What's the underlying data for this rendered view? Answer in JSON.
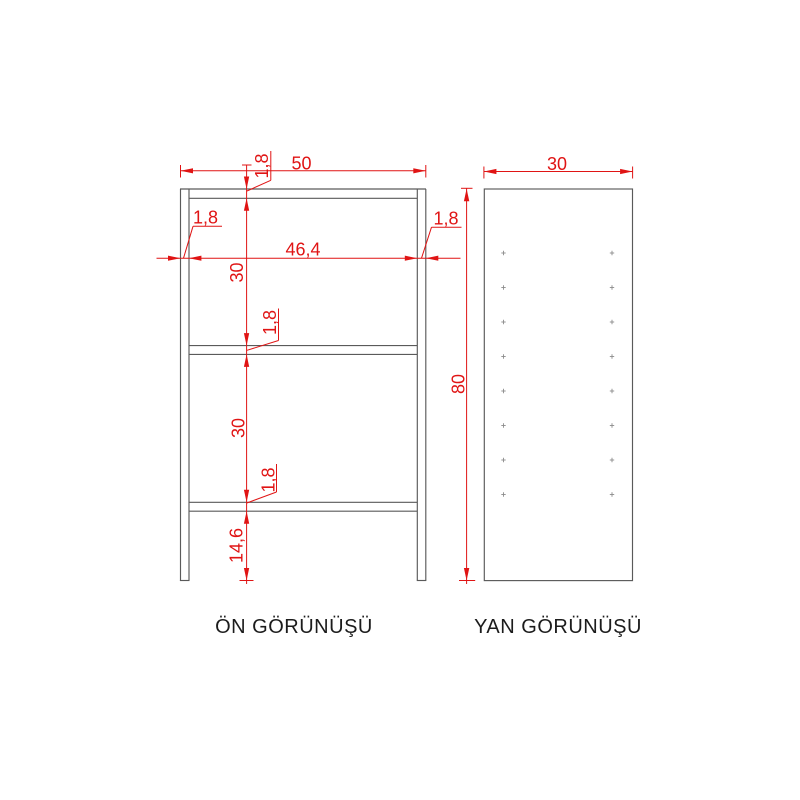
{
  "drawing_title": "cabinet technical drawing",
  "front_view": {
    "label": "ÖN GÖRÜNÜŞÜ",
    "dimensions": {
      "overall_width": "50",
      "inner_width": "46,4",
      "top_panel_thickness": "1,8",
      "left_panel_thickness": "1,8",
      "right_panel_thickness": "1,8",
      "upper_shelf_gap": "30",
      "middle_shelf_thickness": "1,8",
      "lower_shelf_gap": "30",
      "bottom_shelf_thickness": "1,8",
      "foot_height": "14,6"
    }
  },
  "side_view": {
    "label": "YAN GÖRÜNÜŞÜ",
    "dimensions": {
      "depth": "30",
      "overall_height": "80"
    },
    "shelf_pin_holes": {
      "columns": 2,
      "rows": 8
    }
  },
  "colors": {
    "dimension": "#e01414",
    "object": "#5a5a5a",
    "hole": "#8c8c8c",
    "label": "#1c1c1c",
    "background": "#ffffff"
  }
}
